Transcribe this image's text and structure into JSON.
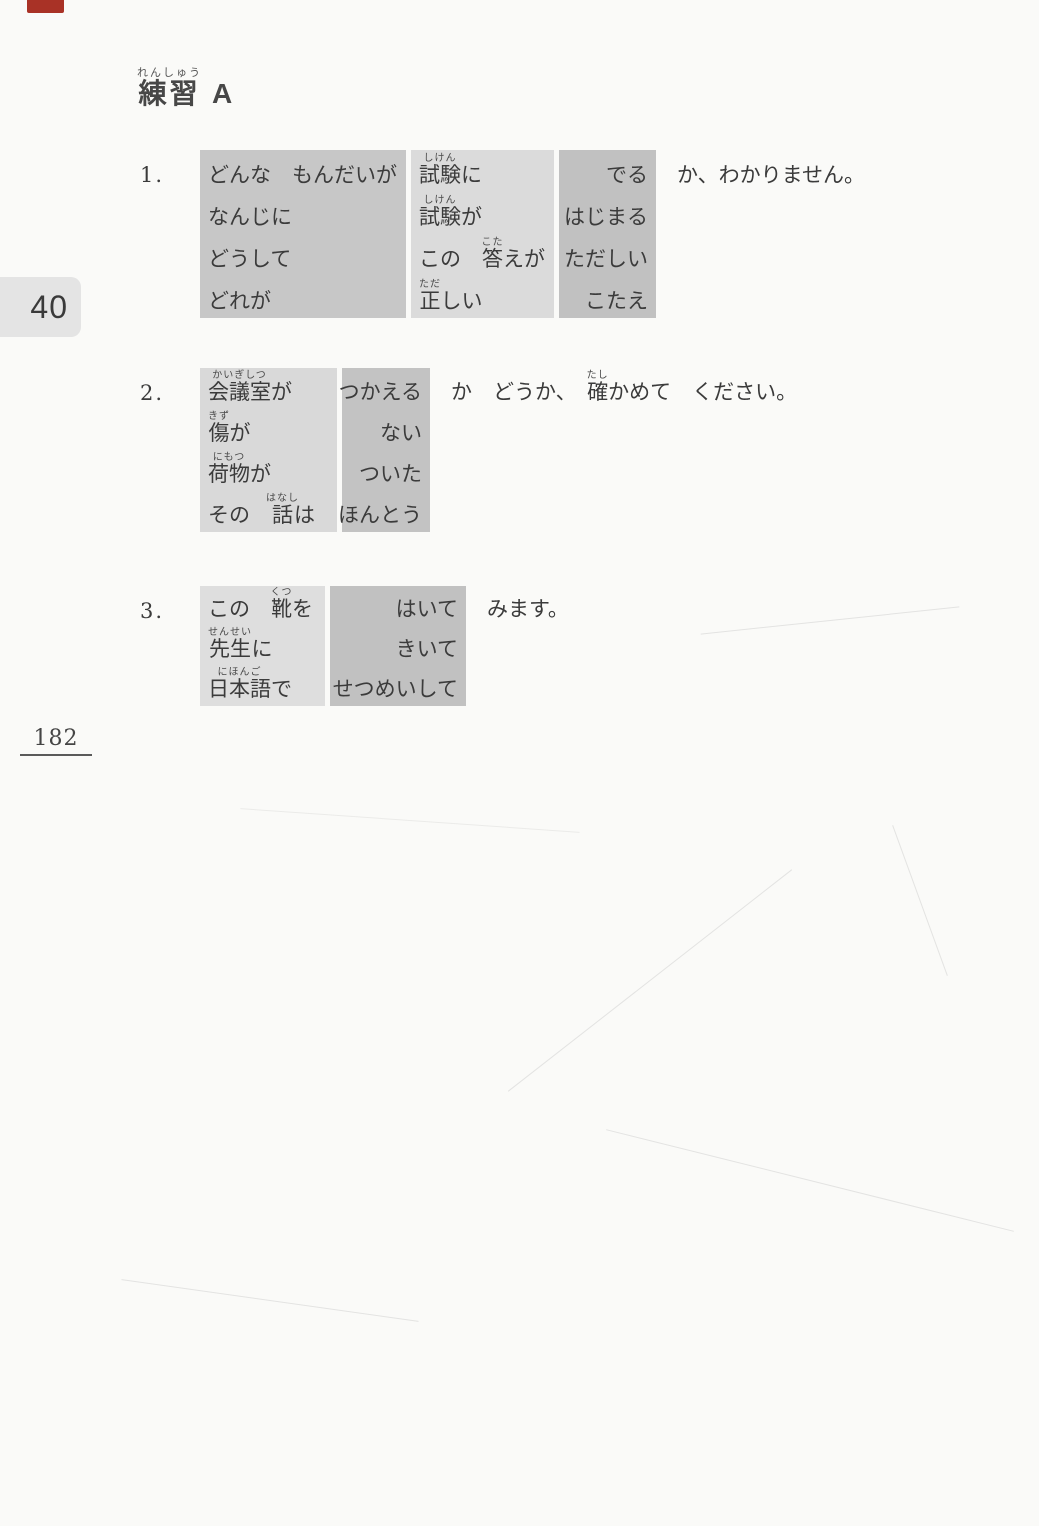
{
  "page": {
    "chapter_tab": "40",
    "page_number": "182"
  },
  "colors": {
    "paper": "#fafaf8",
    "ink": "#3b3b3b",
    "chapter_tab_bg": "#e4e4e4",
    "red_edge_mark": "#a93226",
    "box_shade_dark": "#c4c4c4",
    "box_shade_light": "#dbdbdb"
  },
  "header": {
    "segments": [
      {
        "t": "練習",
        "r": "れんしゅう"
      },
      {
        "t": " A"
      }
    ]
  },
  "exercises": [
    {
      "number": "1.",
      "top": 150,
      "columns": [
        {
          "width": 206,
          "bg": "#c7c7c7",
          "align": "left"
        },
        {
          "width": 143,
          "bg": "#dbdbdb",
          "align": "left"
        },
        {
          "width": 97,
          "bg": "#c1c1c1",
          "align": "right"
        }
      ],
      "rows": [
        {
          "cells": [
            [
              {
                "t": "どんな　もんだいが"
              }
            ],
            [
              {
                "t": "試験",
                "r": "しけん"
              },
              {
                "t": "に"
              }
            ],
            [
              {
                "t": "でる"
              }
            ]
          ],
          "after": [
            {
              "t": "か、わかりません。"
            }
          ]
        },
        {
          "cells": [
            [
              {
                "t": "なんじに"
              }
            ],
            [
              {
                "t": "試験",
                "r": "しけん"
              },
              {
                "t": "が"
              }
            ],
            [
              {
                "t": "はじまる"
              }
            ]
          ]
        },
        {
          "cells": [
            [
              {
                "t": "どうして"
              }
            ],
            [
              {
                "t": "この　"
              },
              {
                "t": "答",
                "r": "こた"
              },
              {
                "t": "えが"
              }
            ],
            [
              {
                "t": "ただしい"
              }
            ]
          ]
        },
        {
          "cells": [
            [
              {
                "t": "どれが"
              }
            ],
            [
              {
                "t": "正",
                "r": "ただ"
              },
              {
                "t": "しい"
              }
            ],
            [
              {
                "t": "こたえ"
              }
            ]
          ]
        }
      ]
    },
    {
      "number": "2.",
      "top": 368,
      "columns": [
        {
          "width": 137,
          "bg": "#d9d9d9",
          "align": "left"
        },
        {
          "width": 88,
          "bg": "#c3c3c3",
          "align": "right"
        }
      ],
      "rows": [
        {
          "cells": [
            [
              {
                "t": "会議室",
                "r": "かいぎしつ"
              },
              {
                "t": "が"
              }
            ],
            [
              {
                "t": "つかえる"
              }
            ]
          ],
          "after": [
            {
              "t": "か　どうか、　"
            },
            {
              "t": "確",
              "r": "たし"
            },
            {
              "t": "かめて　ください。"
            }
          ]
        },
        {
          "cells": [
            [
              {
                "t": "傷",
                "r": "きず"
              },
              {
                "t": "が"
              }
            ],
            [
              {
                "t": "ない"
              }
            ]
          ]
        },
        {
          "cells": [
            [
              {
                "t": "荷物",
                "r": "にもつ"
              },
              {
                "t": "が"
              }
            ],
            [
              {
                "t": "ついた"
              }
            ]
          ]
        },
        {
          "cells": [
            [
              {
                "t": "その　"
              },
              {
                "t": "話",
                "r": "はなし"
              },
              {
                "t": "は"
              }
            ],
            [
              {
                "t": "ほんとう"
              }
            ]
          ]
        }
      ]
    },
    {
      "number": "3.",
      "top": 586,
      "columns": [
        {
          "width": 125,
          "bg": "#dedede",
          "align": "left"
        },
        {
          "width": 136,
          "bg": "#c1c1c1",
          "align": "right"
        }
      ],
      "rows": [
        {
          "cells": [
            [
              {
                "t": "この　"
              },
              {
                "t": "靴",
                "r": "くつ"
              },
              {
                "t": "を"
              }
            ],
            [
              {
                "t": "はいて"
              }
            ]
          ],
          "after": [
            {
              "t": "みます。"
            }
          ]
        },
        {
          "cells": [
            [
              {
                "t": "先生",
                "r": "せんせい"
              },
              {
                "t": "に"
              }
            ],
            [
              {
                "t": "きいて"
              }
            ]
          ]
        },
        {
          "cells": [
            [
              {
                "t": "日本語",
                "r": "にほんご"
              },
              {
                "t": "で"
              }
            ],
            [
              {
                "t": "せつめいして"
              }
            ]
          ]
        }
      ]
    }
  ]
}
